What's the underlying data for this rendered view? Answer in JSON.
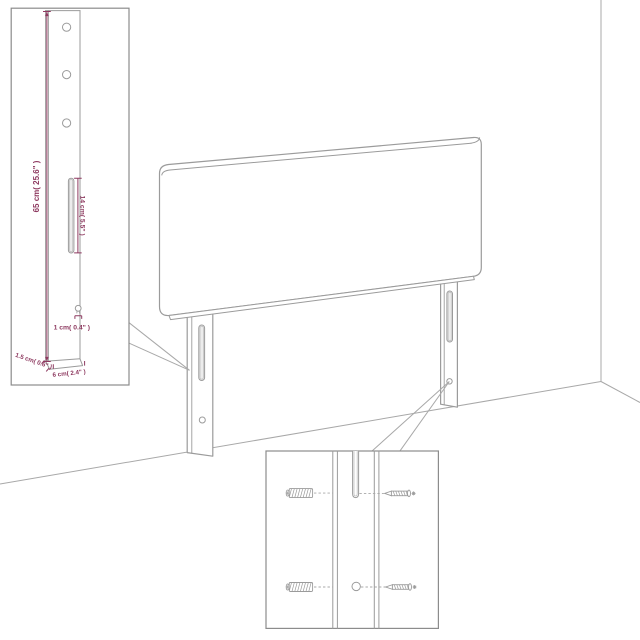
{
  "figure": {
    "subject": "headboard-with-legs-assembly-diagram"
  },
  "colors": {
    "background": "#ffffff",
    "outline": "#9b9b9b",
    "wall": "#a8a8a8",
    "dimension": "#8e3a60",
    "inset_border": "#8c8c8c"
  },
  "insets": {
    "leg_dimensions": {
      "labels": {
        "height": "65 cm( 25.6\" )",
        "slot_length": "14 cm( 5.5\" )",
        "hole": "1 cm( 0.4\" )",
        "thickness": "1.5 cm( 0.6\" )",
        "width": "6 cm( 2.4\" )"
      },
      "hole_count": 3
    },
    "hardware_detail": {
      "icons": [
        "confirmat-screw-icon",
        "wood-screw-icon",
        "confirmat-screw-icon",
        "wood-screw-icon"
      ]
    }
  }
}
